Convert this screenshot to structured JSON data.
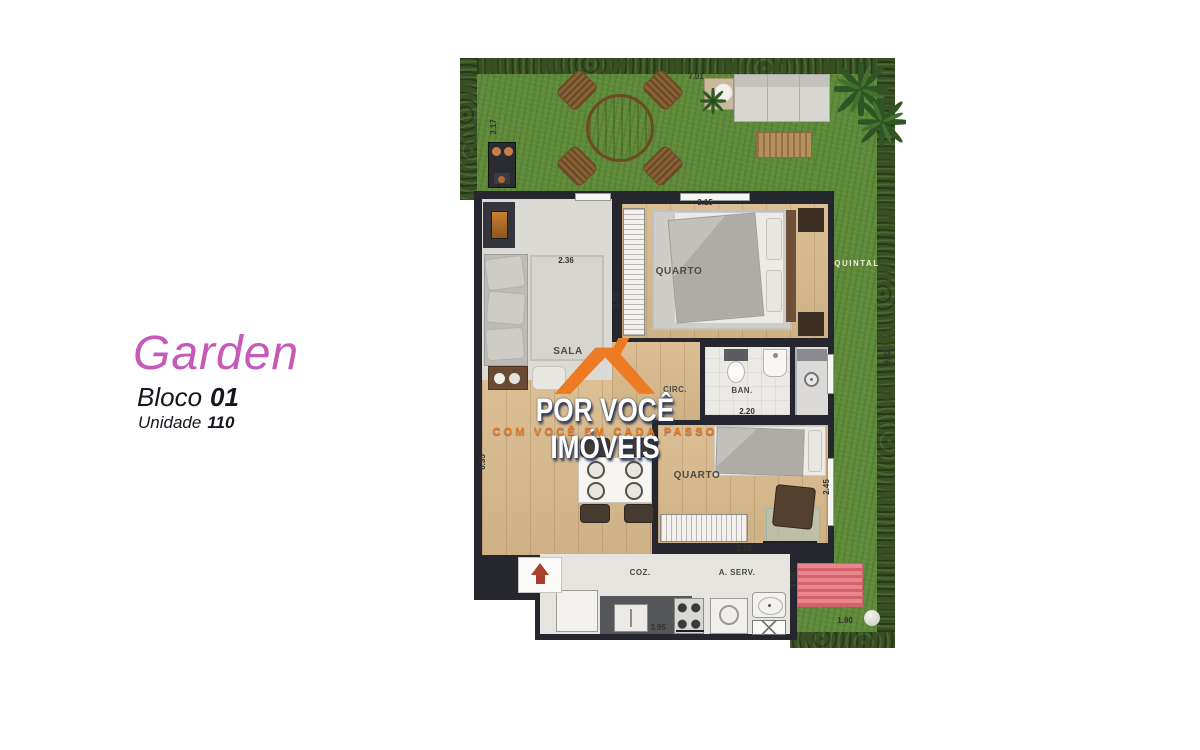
{
  "title_block": {
    "project_name": "Garden",
    "bloco_label": "Bloco",
    "bloco_value": "01",
    "unidade_label": "Unidade",
    "unidade_value": "110"
  },
  "watermark": {
    "line1": "POR VOCÊ IMÓVEIS",
    "line2": "COM VOCÊ EM CADA PASSO"
  },
  "floor_plan": {
    "rooms": {
      "sala": "SALA",
      "quarto1": "QUARTO",
      "circ": "CIRC.",
      "ban": "BAN.",
      "quarto2": "QUARTO",
      "coz": "COZ.",
      "aserv": "A. SERV.",
      "quintal": "QUINTAL"
    },
    "dims": {
      "garden_top": "7.01",
      "garden_left": "3.17",
      "sala_w": "2.36",
      "quarto1_w": "3.15",
      "wall_tv": "1.95",
      "left_h": "6.35",
      "quintal_h": "9.82",
      "ban_w": "2.20",
      "quarto2_h": "2.45",
      "quarto2_w": "3.15",
      "coz_w": "3.95",
      "pergola_h": "1.55",
      "pergola_w": "1.90"
    },
    "colors": {
      "grass": "#5e8a3a",
      "hedge": "#374f22",
      "wall": "#26272e",
      "wood_floor": "#d9ba8c",
      "accent_orange": "#ED7B23",
      "title_pink": "#c55ab8",
      "pergola_pink": "#e9868d",
      "arrow_red": "#a8402c"
    }
  }
}
